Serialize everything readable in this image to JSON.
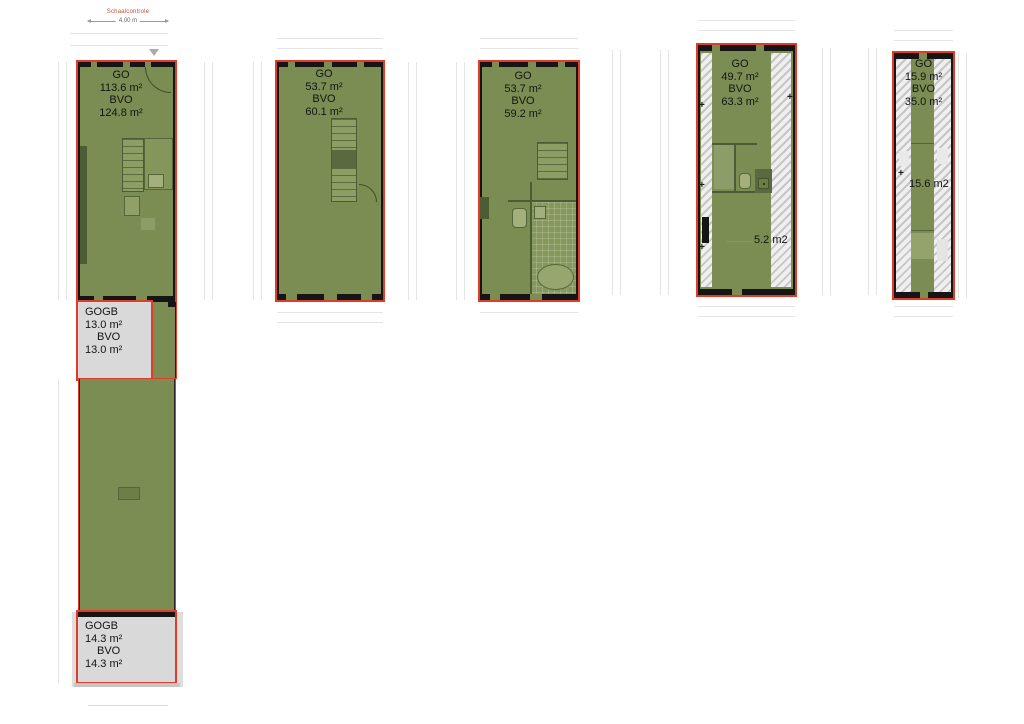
{
  "scale_control": {
    "label": "Schaalcontrole",
    "value": "4,00 m"
  },
  "markers": {
    "plus": "+"
  },
  "colors": {
    "floor-green": "#7b8d52",
    "outline-red": "#e23b27",
    "wall-black": "#151515",
    "gogb-gray": "#d9d9d9"
  },
  "units": {
    "unit1": {
      "go": {
        "label": "GO",
        "area": "113.6 m²",
        "bvo_label": "BVO",
        "bvo_area": "124.8 m²"
      },
      "gogb_top": {
        "label": "GOGB",
        "area": "13.0 m²",
        "bvo_label": "BVO",
        "bvo_area": "13.0 m²"
      },
      "gogb_bottom": {
        "label": "GOGB",
        "area": "14.3 m²",
        "bvo_label": "BVO",
        "bvo_area": "14.3 m²"
      }
    },
    "unit2": {
      "go": {
        "label": "GO",
        "area": "53.7 m²",
        "bvo_label": "BVO",
        "bvo_area": "60.1 m²"
      }
    },
    "unit3": {
      "go": {
        "label": "GO",
        "area": "53.7 m²",
        "bvo_label": "BVO",
        "bvo_area": "59.2 m²"
      }
    },
    "unit4": {
      "go": {
        "label": "GO",
        "area": "49.7 m²",
        "bvo_label": "BVO",
        "bvo_area": "63.3 m²"
      },
      "annotation": "5.2 m2"
    },
    "unit5": {
      "go": {
        "label": "GO",
        "area": "15.9 m²",
        "bvo_label": "BVO",
        "bvo_area": "35.0 m²"
      },
      "annotation": "15.6 m2"
    }
  }
}
